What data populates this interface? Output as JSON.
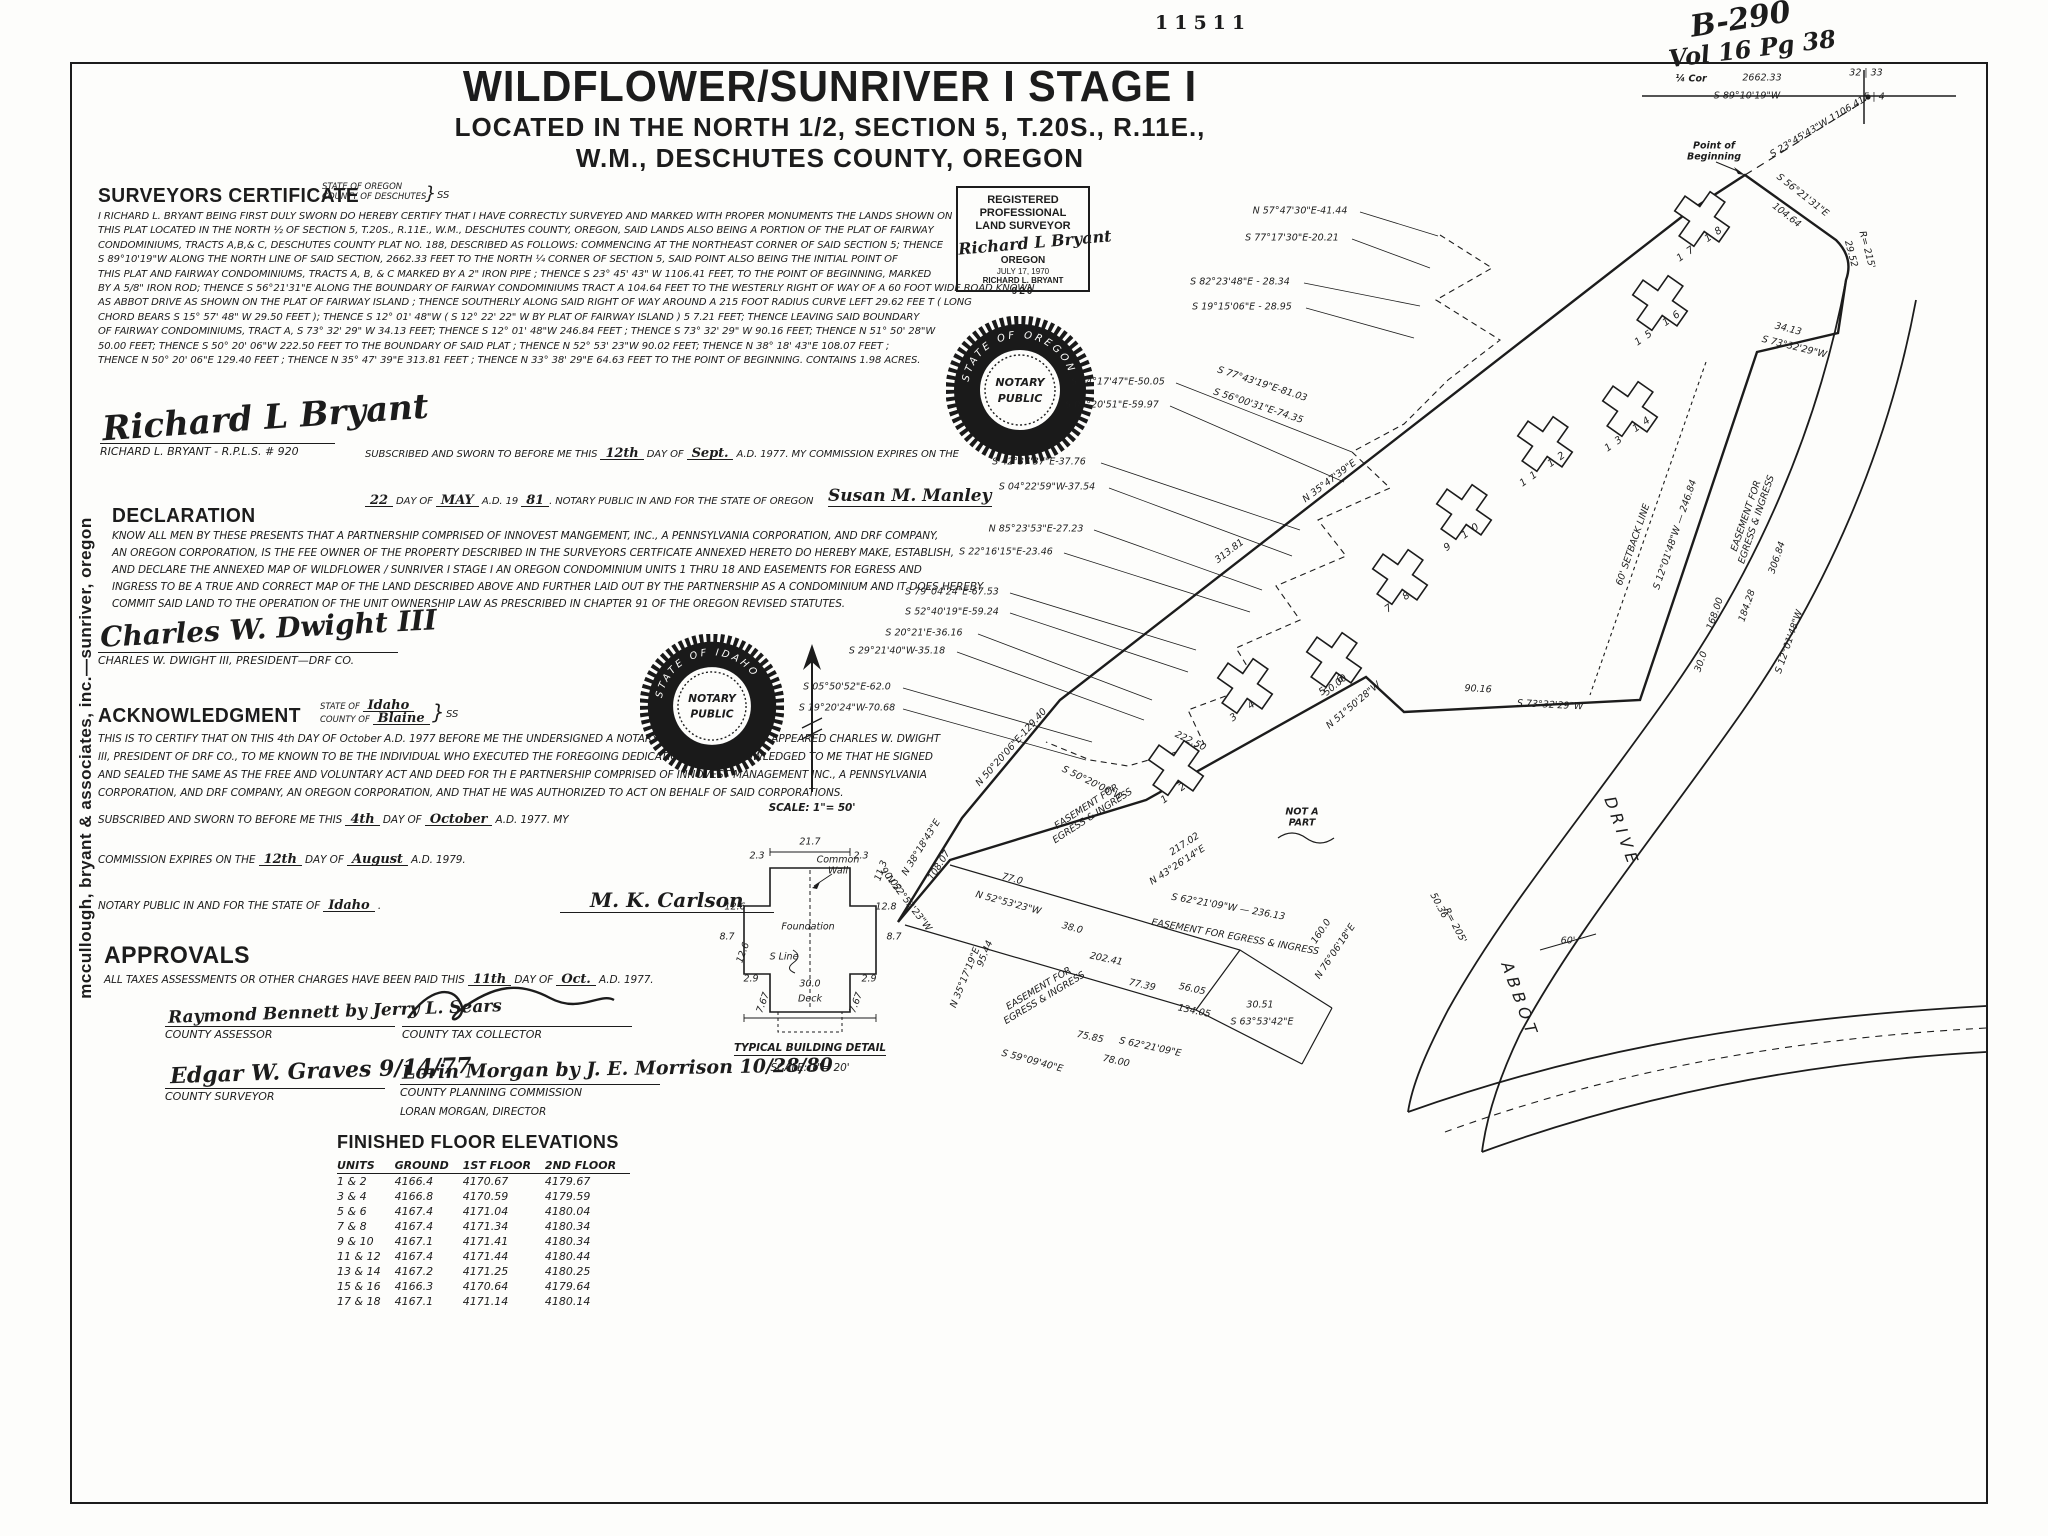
{
  "meta": {
    "stamp_number": "11511",
    "handwritten_book": "B-290",
    "handwritten_vol": "Vol 16 Pg 38"
  },
  "title": {
    "main": "WILDFLOWER/SUNRIVER I  STAGE I",
    "sub1": "LOCATED IN THE NORTH 1/2, SECTION 5, T.20S., R.11E.,",
    "sub2": "W.M., DESCHUTES COUNTY, OREGON"
  },
  "margin_note": "mccullough, bryant & associates, inc.—sunriver, oregon",
  "surveyors_certificate": {
    "heading": "SURVEYORS  CERTIFICATE",
    "state_line": "STATE OF OREGON",
    "county_line": "COUNTY OF DESCHUTES",
    "ss": "SS",
    "body": [
      "I RICHARD L. BRYANT BEING FIRST DULY SWORN DO HEREBY CERTIFY THAT I HAVE CORRECTLY SURVEYED AND MARKED WITH PROPER MONUMENTS  THE LANDS SHOWN ON",
      "THIS  PLAT LOCATED IN THE  NORTH ½ OF SECTION 5,  T.20S.,  R.11E.,  W.M., DESCHUTES  COUNTY, OREGON,  SAID  LANDS  ALSO BEING  A  PORTION OF THE PLAT OF FAIRWAY",
      "CONDOMINIUMS,  TRACTS  A,B,& C,  DESCHUTES  COUNTY  PLAT  NO. 188,  DESCRIBED  AS  FOLLOWS:  COMMENCING  AT  THE NORTHEAST  CORNER  OF  SAID  SECTION  5;  THENCE",
      "S 89°10'19\"W  ALONG  THE  NORTH  LINE  OF  SAID SECTION,  2662.33  FEET TO THE  NORTH  ¼  CORNER OF SECTION  5,  SAID  POINT  ALSO BEING  THE  INITIAL  POINT OF",
      "THIS  PLAT AND FAIRWAY  CONDOMINIUMS,  TRACTS  A, B, & C  MARKED  BY A 2\" IRON  PIPE ;  THENCE  S 23° 45' 43\" W  1106.41  FEET,  TO  THE  POINT  OF  BEGINNING,  MARKED",
      "BY  A  5/8\"  IRON ROD;  THENCE  S 56°21'31\"E  ALONG  THE  BOUNDARY  OF FAIRWAY  CONDOMINIUMS  TRACT A  104.64  FEET TO THE  WESTERLY  RIGHT OF WAY  OF A 60 FOOT WIDE ROAD KNOWN",
      "AS  ABBOT  DRIVE  AS SHOWN  ON  THE PLAT  OF  FAIRWAY  ISLAND ;  THENCE   SOUTHERLY  ALONG  SAID  RIGHT  OF  WAY  AROUND  A  215  FOOT  RADIUS  CURVE  LEFT  29.62  FEE T ( LONG",
      "CHORD  BEARS   S 15° 57' 48\" W  29.50  FEET );  THENCE  S 12° 01' 48\"W  ( S  12° 22' 22\" W  BY  PLAT OF  FAIRWAY  ISLAND )  5 7.21  FEET;  THENCE  LEAVING  SAID  BOUNDARY",
      "OF  FAIRWAY  CONDOMINIUMS,   TRACT A,  S 73° 32' 29\" W  34.13  FEET;  THENCE   S  12° 01' 48\"W  246.84  FEET ;  THENCE   S  73° 32' 29\" W  90.16  FEET;  THENCE  N 51° 50' 28\"W",
      "50.00  FEET;  THENCE  S 50° 20' 06\"W  222.50 FEET  TO  THE  BOUNDARY  OF  SAID  PLAT ;  THENCE  N 52° 53' 23\"W  90.02  FEET;  THENCE  N 38° 18' 43\"E  108.07  FEET ;",
      "THENCE  N 50° 20' 06\"E  129.40  FEET ;  THENCE  N 35° 47' 39\"E  313.81 FEET ;   THENCE  N 33° 38' 29\"E  64.63  FEET TO THE  POINT  OF  BEGINNING.  CONTAINS  1.98  ACRES."
    ],
    "signature": "Richard L Bryant",
    "signer_label": "RICHARD L. BRYANT - R.P.L.S.  # 920",
    "sub1_a": "SUBSCRIBED  AND SWORN  TO BEFORE  ME THIS ",
    "sub1_day": "12th",
    "sub1_b": " DAY OF ",
    "sub1_month": "Sept.",
    "sub1_c": " A.D. 1977.  MY COMMISSION  EXPIRES ON THE",
    "sub2_day": "22",
    "sub2_a": " DAY OF ",
    "sub2_month": "MAY",
    "sub2_b": " A.D. 19 ",
    "sub2_year": "81",
    "sub2_c": ". NOTARY PUBLIC  IN AND FOR  THE STATE OF OREGON",
    "notary_signature": "Susan M. Manley"
  },
  "declaration": {
    "heading": "DECLARATION",
    "body": [
      "KNOW ALL MEN  BY  THESE  PRESENTS  THAT A PARTNERSHIP  COMPRISED  OF  INNOVEST  MANGEMENT,  INC., A PENNSYLVANIA  CORPORATION,  AND  DRF  COMPANY,",
      "AN  OREGON  CORPORATION,  IS  THE  FEE  OWNER  OF  THE  PROPERTY   DESCRIBED  IN THE  SURVEYORS  CERTFICATE  ANNEXED  HERETO  DO HEREBY  MAKE,  ESTABLISH,",
      "AND DECLARE  THE  ANNEXED  MAP OF  WILDFLOWER / SUNRIVER  I  STAGE  I   AN  OREGON CONDOMINIUM   UNITS  1 THRU 18  AND EASEMENTS  FOR  EGRESS  AND",
      "INGRESS  TO BE A TRUE  AND CORRECT   MAP  OF  THE  LAND   DESCRIBED   ABOVE  AND  FURTHER   LAID OUT  BY  THE  PARTNERSHIP  AS A  CONDOMINIUM  AND IT  DOES  HEREBY",
      "COMMIT  SAID LAND  TO  THE  OPERATION  OF  THE  UNIT  OWNERSHIP  LAW  AS  PRESCRIBED  IN  CHAPTER  91  OF  THE  OREGON   REVISED  STATUTES."
    ],
    "signature": "Charles W. Dwight III",
    "signer_label": "CHARLES W. DWIGHT III,  PRESIDENT—DRF CO."
  },
  "acknowledgment": {
    "heading": "ACKNOWLEDGMENT",
    "state_a": "STATE OF ",
    "state_val": "Idaho",
    "county_a": "COUNTY OF ",
    "county_val": "Blaine",
    "ss": "SS",
    "body": [
      "THIS  IS TO CERTIFY  THAT ON  THIS  4th  DAY OF October  A.D. 1977   BEFORE  ME  THE  UNDERSIGNED  A  NOTARY  PUBLIC   PERSONALLY   APPEARED  CHARLES  W.  DWIGHT",
      "III,  PRESIDENT OF  DRF CO., TO ME  KNOWN  TO  BE  THE  INDIVIDUAL  WHO EXECUTED  THE  FOREGOING   DEDICATION  AND  ACKNOWLEDGED  TO  ME  THAT  HE SIGNED",
      "AND SEALED  THE  SAME  AS  THE  FREE  AND  VOLUNTARY  ACT  AND  DEED  FOR  TH E   PARTNERSHIP  COMPRISED  OF  INNOVEST  MANAGEMENT  INC., A PENNSYLVANIA",
      "CORPORATION,  AND   DRF  COMPANY,  AN  OREGON  CORPORATION,  AND  THAT  HE  WAS  AUTHORIZED  TO  ACT  ON  BEHALF  OF  SAID  CORPORATIONS."
    ],
    "sub_a": "SUBSCRIBED   AND   SWORN  TO  BEFORE  ME  THIS ",
    "sub_day": "4th",
    "sub_b": "  DAY   OF  ",
    "sub_month": "October",
    "sub_c": " A.D. 1977.  MY",
    "comm_a": "COMMISSION  EXPIRES  ON  THE ",
    "comm_day": "12th",
    "comm_b": "  DAY OF  ",
    "comm_month": "August",
    "comm_c": "  A.D.  1979.",
    "notary_a": "NOTARY  PUBLIC  IN  AND  FOR  THE  STATE  OF ",
    "notary_state": "Idaho",
    "notary_b": " .",
    "notary_signature": "M. K. Carlson"
  },
  "approvals": {
    "heading": "APPROVALS",
    "line_a": "ALL  TAXES   ASSESSMENTS  OR  OTHER  CHARGES   HAVE BEEN   PAID  THIS ",
    "line_day": "11th",
    "line_b": " DAY OF ",
    "line_month": "Oct.",
    "line_c": " A.D. 1977.",
    "sig_assessor": "Raymond Bennett by Jerry L. Sears",
    "label_assessor": "COUNTY  ASSESSOR",
    "label_tax": "COUNTY  TAX  COLLECTOR",
    "sig_surveyor": "Edgar W. Graves    9/14/77",
    "label_surveyor": "COUNTY  SURVEYOR",
    "sig_planning": "Lorin Morgan by J. E. Morrison 10/28/80",
    "label_planning": "COUNTY  PLANNING  COMMISSION",
    "label_planning2": "LORAN  MORGAN,  DIRECTOR"
  },
  "floor_elevations": {
    "title": "FINISHED  FLOOR  ELEVATIONS",
    "headers": [
      "UNITS",
      "GROUND",
      "1ST  FLOOR",
      "2ND  FLOOR"
    ],
    "rows": [
      [
        "1  &  2",
        "4166.4",
        "4170.67",
        "4179.67"
      ],
      [
        "3  &  4",
        "4166.8",
        "4170.59",
        "4179.59"
      ],
      [
        "5  &  6",
        "4167.4",
        "4171.04",
        "4180.04"
      ],
      [
        "7  &  8",
        "4167.4",
        "4171.34",
        "4180.34"
      ],
      [
        "9  &  10",
        "4167.1",
        "4171.41",
        "4180.34"
      ],
      [
        "11 &  12",
        "4167.4",
        "4171.44",
        "4180.44"
      ],
      [
        "13 &  14",
        "4167.2",
        "4171.25",
        "4180.25"
      ],
      [
        "15 &  16",
        "4166.3",
        "4170.64",
        "4179.64"
      ],
      [
        "17 &  18",
        "4167.1",
        "4171.14",
        "4180.14"
      ]
    ]
  },
  "surveyor_stamp": {
    "line1": "REGISTERED",
    "line2": "PROFESSIONAL",
    "line3": "LAND SURVEYOR",
    "signature": "Richard L Bryant",
    "state": "OREGON",
    "date": "JULY 17, 1970",
    "name": "RICHARD L. BRYANT",
    "number": "920"
  },
  "notary_seals": [
    {
      "center1": "NOTARY",
      "center2": "PUBLIC",
      "ring": "STATE OF OREGON"
    },
    {
      "center1": "NOTARY",
      "center2": "PUBLIC",
      "ring": "STATE OF IDAHO"
    }
  ],
  "scale_note": "SCALE:  1\"= 50'",
  "building_detail": {
    "caption": "TYPICAL  BUILDING  DETAIL",
    "scale": "SCALE:  1\"= 20'",
    "common_wall": "Common\nWall",
    "foundation": "Foundation",
    "s_line": "S  Line",
    "deck": "Deck",
    "dims": [
      {
        "t": "21.7",
        "x": 810,
        "y": 843,
        "r": 0
      },
      {
        "t": "2.3",
        "x": 757,
        "y": 857,
        "r": 0
      },
      {
        "t": "2.3",
        "x": 861,
        "y": 857,
        "r": 0
      },
      {
        "t": "11.3",
        "x": 882,
        "y": 871,
        "r": -70
      },
      {
        "t": "12.6",
        "x": 735,
        "y": 908,
        "r": 0
      },
      {
        "t": "12.8",
        "x": 886,
        "y": 908,
        "r": 0
      },
      {
        "t": "8.7",
        "x": 727,
        "y": 938,
        "r": 0
      },
      {
        "t": "8.7",
        "x": 894,
        "y": 938,
        "r": 0
      },
      {
        "t": "2.9",
        "x": 751,
        "y": 980,
        "r": 0
      },
      {
        "t": "2.9",
        "x": 869,
        "y": 980,
        "r": 0
      },
      {
        "t": "7.67",
        "x": 764,
        "y": 1003,
        "r": -70
      },
      {
        "t": "7.67",
        "x": 857,
        "y": 1003,
        "r": -70
      },
      {
        "t": "30.0",
        "x": 810,
        "y": 985,
        "r": 0
      },
      {
        "t": "12.6",
        "x": 744,
        "y": 953,
        "r": -70
      }
    ]
  },
  "map": {
    "labels": [
      {
        "t": "¼ Cor",
        "x": 1691,
        "y": 80,
        "r": 0,
        "cls": "hand-lbl"
      },
      {
        "t": "2662.33",
        "x": 1762,
        "y": 79,
        "r": 0
      },
      {
        "t": "32 | 33",
        "x": 1866,
        "y": 74,
        "r": 0
      },
      {
        "t": "S 89°10'19\"W",
        "x": 1747,
        "y": 97,
        "r": 0
      },
      {
        "t": "5 | 4",
        "x": 1874,
        "y": 98,
        "r": 0
      },
      {
        "t": "Point  of\nBeginning",
        "x": 1714,
        "y": 152,
        "r": 0,
        "cls": "hand-lbl"
      },
      {
        "t": "S 56°21'31\"E",
        "x": 1802,
        "y": 196,
        "r": 38
      },
      {
        "t": "104.64",
        "x": 1786,
        "y": 216,
        "r": 38
      },
      {
        "t": "N 57°47'30\"E-41.44",
        "x": 1300,
        "y": 212,
        "r": 0
      },
      {
        "t": "S 77°17'30\"E-20.21",
        "x": 1292,
        "y": 239,
        "r": 0
      },
      {
        "t": "S 82°23'48\"E - 28.34",
        "x": 1240,
        "y": 283,
        "r": 0
      },
      {
        "t": "S 19°15'06\"E - 28.95",
        "x": 1242,
        "y": 308,
        "r": 0
      },
      {
        "t": "29.52",
        "x": 1850,
        "y": 254,
        "r": 75
      },
      {
        "t": "R= 215'",
        "x": 1866,
        "y": 250,
        "r": 75
      },
      {
        "t": "S 23°45'43\"W  1106.41",
        "x": 1818,
        "y": 128,
        "r": -31
      },
      {
        "t": "313.81",
        "x": 1230,
        "y": 552,
        "r": -37
      },
      {
        "t": "N 35°47'39\"E",
        "x": 1330,
        "y": 482,
        "r": -37
      },
      {
        "t": "34.13",
        "x": 1788,
        "y": 330,
        "r": 14
      },
      {
        "t": "S 73°32'29\"W",
        "x": 1794,
        "y": 348,
        "r": 14
      },
      {
        "t": "S 34°17'47\"E-50.05",
        "x": 1118,
        "y": 383,
        "r": 0
      },
      {
        "t": "S 77°43'19\"E-81.03",
        "x": 1262,
        "y": 385,
        "r": 18
      },
      {
        "t": "S 04°20'51\"E-59.97",
        "x": 1112,
        "y": 406,
        "r": 0
      },
      {
        "t": "S 56°00'31\"E-74.35",
        "x": 1258,
        "y": 407,
        "r": 18
      },
      {
        "t": "S 42°37'37\"E-37.76",
        "x": 1039,
        "y": 463,
        "r": 0
      },
      {
        "t": "S 04°22'59\"W-37.54",
        "x": 1047,
        "y": 488,
        "r": 0
      },
      {
        "t": "N 85°23'53\"E-27.23",
        "x": 1036,
        "y": 530,
        "r": 0
      },
      {
        "t": "S 22°16'15\"E-23.46",
        "x": 1006,
        "y": 553,
        "r": 0
      },
      {
        "t": "S 79°04'24\"E-67.53",
        "x": 952,
        "y": 593,
        "r": 0
      },
      {
        "t": "S 52°40'19\"E-59.24",
        "x": 952,
        "y": 613,
        "r": 0
      },
      {
        "t": "S 20°21'E-36.16",
        "x": 924,
        "y": 634,
        "r": 0
      },
      {
        "t": "S 29°21'40\"W-35.18",
        "x": 897,
        "y": 652,
        "r": 0
      },
      {
        "t": "S 05°50'52\"E-62.0",
        "x": 847,
        "y": 688,
        "r": 0
      },
      {
        "t": "S 19°20'24\"W-70.68",
        "x": 847,
        "y": 709,
        "r": 0
      },
      {
        "t": "N 50°20'06\"E-129.40",
        "x": 1012,
        "y": 748,
        "r": -48
      },
      {
        "t": "N 38°18'43\"E",
        "x": 922,
        "y": 848,
        "r": -58
      },
      {
        "t": "108.07",
        "x": 940,
        "y": 866,
        "r": -58
      },
      {
        "t": "90.02",
        "x": 890,
        "y": 880,
        "r": 52
      },
      {
        "t": "N 52°53'23\"W",
        "x": 908,
        "y": 904,
        "r": 52
      },
      {
        "t": "S 50°20'06\"W",
        "x": 1092,
        "y": 784,
        "r": 26
      },
      {
        "t": "222.50",
        "x": 1190,
        "y": 742,
        "r": 26
      },
      {
        "t": "50.00",
        "x": 1336,
        "y": 686,
        "r": -40
      },
      {
        "t": "N 51°50'28\"W",
        "x": 1354,
        "y": 706,
        "r": -40
      },
      {
        "t": "90.16",
        "x": 1478,
        "y": 690,
        "r": 3
      },
      {
        "t": "S 73°32'29\"W",
        "x": 1550,
        "y": 706,
        "r": 3
      },
      {
        "t": "S 12°01'48\"W — 246.84",
        "x": 1676,
        "y": 535,
        "r": -71
      },
      {
        "t": "EASEMENT  FOR\nEGRESS  &  INGRESS",
        "x": 1752,
        "y": 518,
        "r": -71
      },
      {
        "t": "168.00",
        "x": 1716,
        "y": 614,
        "r": -71
      },
      {
        "t": "184.28",
        "x": 1748,
        "y": 606,
        "r": -71
      },
      {
        "t": "306.84",
        "x": 1778,
        "y": 558,
        "r": -71
      },
      {
        "t": "30.0",
        "x": 1702,
        "y": 662,
        "r": -71
      },
      {
        "t": "S 12°01'48\"W",
        "x": 1790,
        "y": 642,
        "r": -71
      },
      {
        "t": "60'  SETBACK  LINE",
        "x": 1634,
        "y": 545,
        "r": -71
      },
      {
        "t": "DRIVE",
        "x": 1622,
        "y": 832,
        "r": 70,
        "cls": "road"
      },
      {
        "t": "ABBOT",
        "x": 1520,
        "y": 1000,
        "r": 70,
        "cls": "road"
      },
      {
        "t": "50.36",
        "x": 1438,
        "y": 906,
        "r": 62
      },
      {
        "t": "R= 205'",
        "x": 1454,
        "y": 926,
        "r": 62
      },
      {
        "t": "60'",
        "x": 1568,
        "y": 942,
        "r": 0
      },
      {
        "t": "NOT  A\nPART",
        "x": 1302,
        "y": 818,
        "r": 0,
        "cls": "hand-lbl"
      },
      {
        "t": "217.02",
        "x": 1185,
        "y": 845,
        "r": -33
      },
      {
        "t": "N 43°26'14\"E",
        "x": 1178,
        "y": 866,
        "r": -33
      },
      {
        "t": "EASEMENT  FOR\nEGRESS  &  INGRESS",
        "x": 1090,
        "y": 812,
        "r": -33
      },
      {
        "t": "S 62°21'09\"W — 236.13",
        "x": 1228,
        "y": 908,
        "r": 10
      },
      {
        "t": "EASEMENT  FOR  EGRESS  &  INGRESS",
        "x": 1235,
        "y": 938,
        "r": 10
      },
      {
        "t": "160.0",
        "x": 1322,
        "y": 932,
        "r": -56
      },
      {
        "t": "N 76°06'18\"E",
        "x": 1336,
        "y": 952,
        "r": -56
      },
      {
        "t": "77.0",
        "x": 1012,
        "y": 880,
        "r": 15
      },
      {
        "t": "N 52°53'23\"W",
        "x": 1008,
        "y": 904,
        "r": 15
      },
      {
        "t": "38.0",
        "x": 1072,
        "y": 929,
        "r": 15
      },
      {
        "t": "95.44",
        "x": 986,
        "y": 954,
        "r": -68
      },
      {
        "t": "N 35°17'19\"E",
        "x": 966,
        "y": 978,
        "r": -68
      },
      {
        "t": "EASEMENT  FOR\nEGRESS  &  INGRESS",
        "x": 1042,
        "y": 994,
        "r": -31
      },
      {
        "t": "202.41",
        "x": 1106,
        "y": 960,
        "r": 12
      },
      {
        "t": "77.39",
        "x": 1142,
        "y": 986,
        "r": 12
      },
      {
        "t": "56.05",
        "x": 1192,
        "y": 990,
        "r": 12
      },
      {
        "t": "134.05",
        "x": 1194,
        "y": 1012,
        "r": 12
      },
      {
        "t": "75.85",
        "x": 1090,
        "y": 1038,
        "r": 12
      },
      {
        "t": "78.00",
        "x": 1116,
        "y": 1062,
        "r": 12
      },
      {
        "t": "S 59°09'40\"E",
        "x": 1032,
        "y": 1062,
        "r": 15
      },
      {
        "t": "S 62°21'09\"E",
        "x": 1150,
        "y": 1048,
        "r": 12
      },
      {
        "t": "30.51",
        "x": 1260,
        "y": 1006,
        "r": 0
      },
      {
        "t": "S 63°53'42\"E",
        "x": 1262,
        "y": 1023,
        "r": 0
      }
    ],
    "units": [
      {
        "t": "1   2",
        "x": 1176,
        "y": 792,
        "r": -35
      },
      {
        "t": "3   4",
        "x": 1245,
        "y": 710,
        "r": -35
      },
      {
        "t": "5   6",
        "x": 1334,
        "y": 684,
        "r": -35
      },
      {
        "t": "7   8",
        "x": 1400,
        "y": 601,
        "r": -35
      },
      {
        "t": "9   10",
        "x": 1464,
        "y": 536,
        "r": -35
      },
      {
        "t": "11   12",
        "x": 1545,
        "y": 468,
        "r": -35
      },
      {
        "t": "13   14",
        "x": 1630,
        "y": 433,
        "r": -35
      },
      {
        "t": "15   16",
        "x": 1660,
        "y": 327,
        "r": -35
      },
      {
        "t": "17   18",
        "x": 1702,
        "y": 243,
        "r": -35
      }
    ],
    "buildings": [
      {
        "x": 1176,
        "y": 768,
        "r": 35
      },
      {
        "x": 1245,
        "y": 686,
        "r": 35
      },
      {
        "x": 1334,
        "y": 660,
        "r": 35
      },
      {
        "x": 1400,
        "y": 577,
        "r": 35
      },
      {
        "x": 1464,
        "y": 512,
        "r": 35
      },
      {
        "x": 1545,
        "y": 444,
        "r": 35
      },
      {
        "x": 1630,
        "y": 409,
        "r": 35
      },
      {
        "x": 1660,
        "y": 303,
        "r": 35
      },
      {
        "x": 1702,
        "y": 219,
        "r": 35
      }
    ],
    "leaders": [
      [
        1360,
        212,
        1438,
        236
      ],
      [
        1352,
        239,
        1430,
        268
      ],
      [
        1304,
        283,
        1420,
        306
      ],
      [
        1306,
        308,
        1414,
        338
      ],
      [
        1176,
        383,
        1352,
        452
      ],
      [
        1170,
        406,
        1344,
        482
      ],
      [
        1101,
        463,
        1300,
        530
      ],
      [
        1109,
        488,
        1292,
        556
      ],
      [
        1094,
        530,
        1262,
        590
      ],
      [
        1064,
        553,
        1250,
        612
      ],
      [
        1010,
        593,
        1196,
        650
      ],
      [
        1010,
        613,
        1188,
        672
      ],
      [
        978,
        634,
        1152,
        700
      ],
      [
        957,
        652,
        1144,
        720
      ],
      [
        903,
        688,
        1092,
        742
      ],
      [
        903,
        709,
        1086,
        760
      ]
    ]
  }
}
